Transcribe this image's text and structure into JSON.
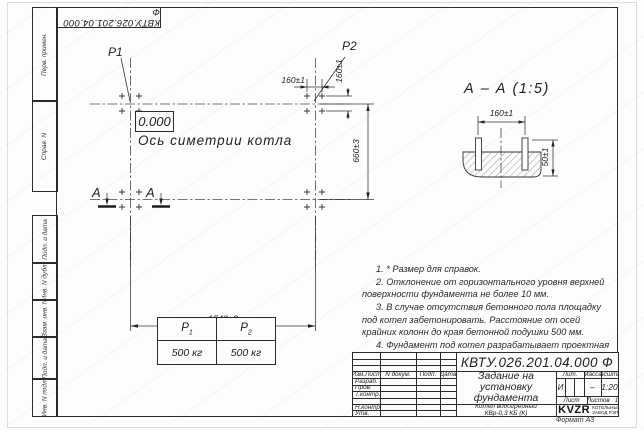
{
  "doc_number": "КВТУ.026.201.04.000  Ф",
  "margins": [
    "Перв. примен.",
    "Справ. N",
    "Подп. и дата",
    "Инв. N дубл.",
    "Взам. инв. N",
    "Подп. и дата",
    "Инв. N подл."
  ],
  "plan": {
    "p1": "P1",
    "p2": "P2",
    "level": "0.000",
    "axis_label": "Ось симетрии котла",
    "dim_160h": "160±1",
    "dim_160v": "160±1",
    "dim_660": "660±3",
    "dim_1540": "1540±2",
    "section_letter": "А"
  },
  "section": {
    "title": "А – А (1:5)",
    "dim_160": "160±1",
    "dim_50": "50±1"
  },
  "notes": [
    "1. * Размер для справок.",
    "2. Отклонение от горизонтального уровня верхней поверхности фундамента не более 10 мм.",
    "3. В случае отсутствия бетонного пола площадку под котел забетонировать. Расстояние от осей крайних колонн до края бетонной подушки 500 мм.",
    "4. Фундамент под котел разрабатывает проектная организация по нагрузкам на фундамент."
  ],
  "load_table": {
    "headers": [
      {
        "base": "P",
        "sub": "1"
      },
      {
        "base": "P",
        "sub": "2"
      }
    ],
    "values": [
      "500 кг",
      "500 кг"
    ]
  },
  "titleblock": {
    "header": [
      "Изм.Лист",
      "N докум.",
      "Подп.",
      "Дата"
    ],
    "rows": [
      "Разраб.",
      "Пров.",
      "Т.контр.",
      "Н.контр.",
      "Утв."
    ],
    "title": [
      "Задание на",
      "установку",
      "фундамента"
    ],
    "product": [
      "Котел водогрейный",
      "КВр-0,3 КБ (К)"
    ],
    "lit_label": "Лит.",
    "mass_label": "Масса",
    "scale_label": "Масштаб",
    "lit_value": "И",
    "mass_value": "–",
    "scale_value": "1:20",
    "sheet_label": "Лист",
    "sheets_label": "Листов",
    "sheets_value": "1",
    "logo_text": "KVZR",
    "logo_caption": [
      "КОТЕЛЬНЫЙ",
      "ЗАВОД РЭП"
    ],
    "format_label": "Формат А3"
  },
  "colors": {
    "line": "#2b2b2b",
    "sheet": "#fdfdfc"
  }
}
